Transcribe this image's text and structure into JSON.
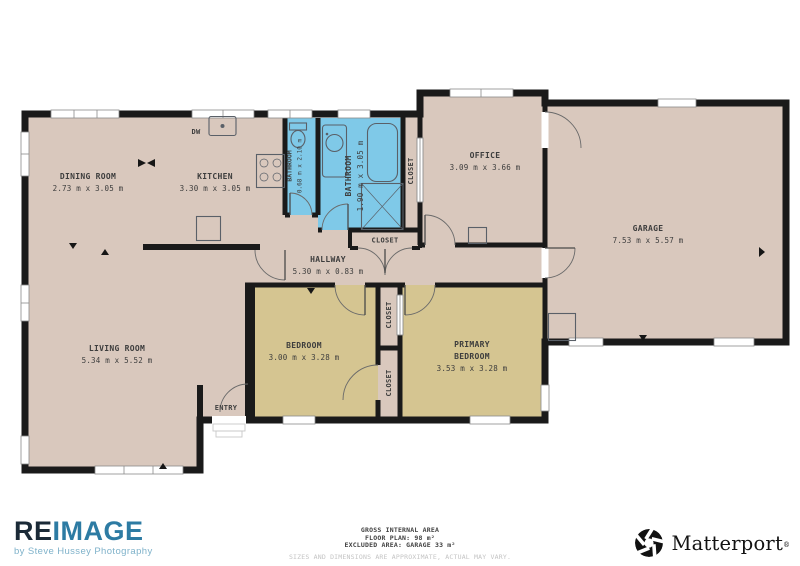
{
  "floor_plan": {
    "rooms": {
      "dining": {
        "name": "DINING ROOM",
        "dims": "2.73 m x 3.05 m"
      },
      "kitchen": {
        "name": "KITCHEN",
        "dims": "3.30 m x 3.05 m"
      },
      "bathroom_small": {
        "name": "BATHROOM",
        "dims": "0.68 m x 2.10 m"
      },
      "bathroom_main": {
        "name": "BATHROOM",
        "dims": "1.90 m x 3.05 m"
      },
      "office": {
        "name": "OFFICE",
        "dims": "3.09 m x 3.66 m"
      },
      "garage": {
        "name": "GARAGE",
        "dims": "7.53 m x 5.57 m"
      },
      "hallway": {
        "name": "HALLWAY",
        "dims": "5.30 m x 0.83 m"
      },
      "living": {
        "name": "LIVING ROOM",
        "dims": "5.34 m x 5.52 m"
      },
      "bedroom": {
        "name": "BEDROOM",
        "dims": "3.00 m x 3.28 m"
      },
      "primary_bedroom": {
        "name_line1": "PRIMARY",
        "name_line2": "BEDROOM",
        "dims": "3.53 m x 3.28 m"
      }
    },
    "labels": {
      "closet": "CLOSET",
      "entry": "ENTRY",
      "dishwasher": "DW"
    },
    "colors": {
      "floor": "#d9c8bd",
      "bedroom_floor": "#d5c591",
      "bathroom_floor": "#7fc9e8",
      "wall": "#1a1a1a"
    }
  },
  "footer": {
    "area_summary": {
      "line1": "GROSS INTERNAL AREA",
      "line2": "FLOOR PLAN: 98 m²",
      "line3": "EXCLUDED AREA: GARAGE 33 m²"
    },
    "disclaimer": "SIZES AND DIMENSIONS ARE APPROXIMATE, ACTUAL MAY VARY.",
    "reimage": {
      "part1": "RE",
      "part2": "IMAGE",
      "tagline": "by Steve Hussey Photography",
      "color_dark": "#1b2a37",
      "color_blue": "#2d7ba3",
      "color_light": "#7fb2ca"
    },
    "matterport": {
      "name": "Matterport",
      "mark": "®"
    }
  }
}
